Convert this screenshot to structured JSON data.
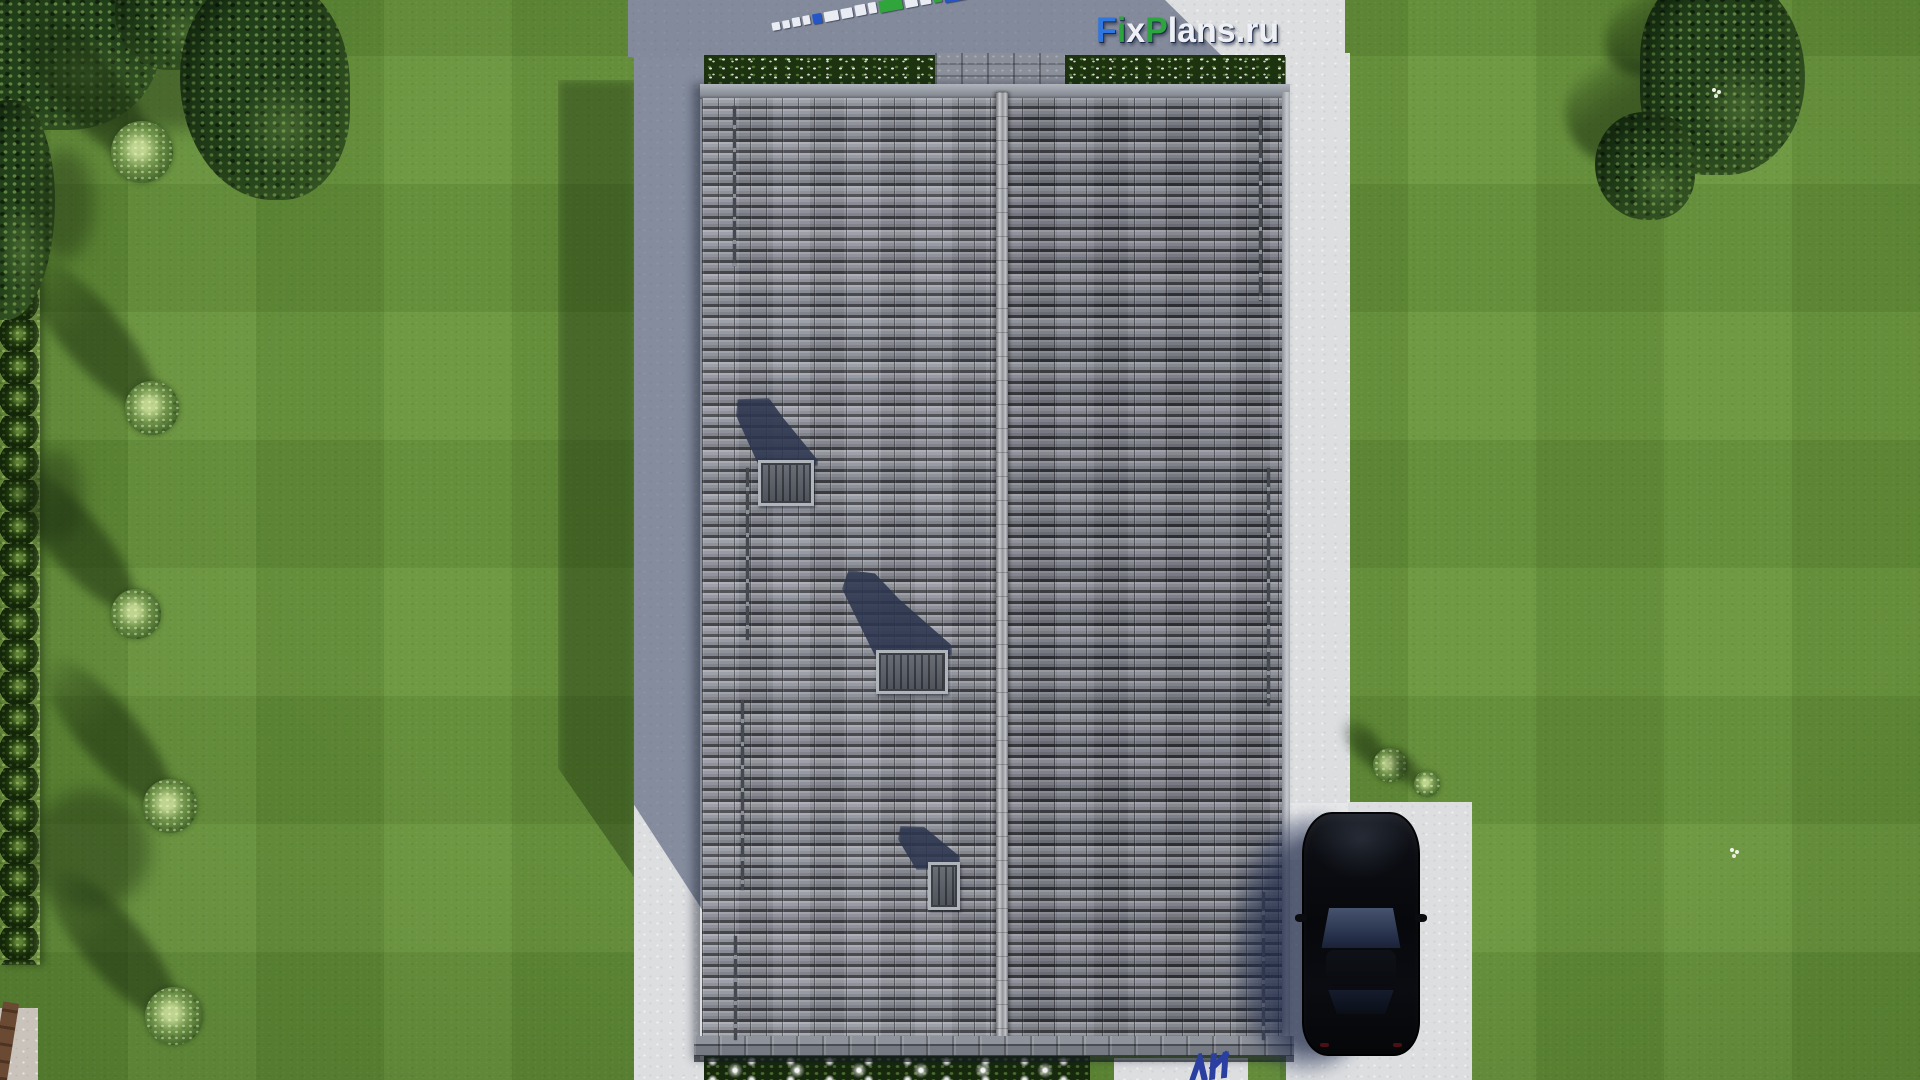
{
  "scene": {
    "title": "Top-down 3D site render: gable-roof house with skylights, lawn, left walkway, right driveway with parked black car",
    "width": 1920,
    "height": 1080,
    "car": {
      "color": "black",
      "state": "parked on driveway, facing up"
    },
    "roof": {
      "slopes": 2,
      "skylights": 3,
      "snow_rails": 7
    }
  },
  "logo": {
    "text": "FixPlans.ru",
    "letters": [
      {
        "ch": "F",
        "color": "#2f76e0"
      },
      {
        "ch": "i",
        "color": "#2da53e"
      },
      {
        "ch": "x",
        "color": "#eef0f5"
      },
      {
        "ch": "P",
        "color": "#2da53e"
      },
      {
        "ch": "l",
        "color": "#eef0f5"
      },
      {
        "ch": "a",
        "color": "#eef0f5"
      },
      {
        "ch": "n",
        "color": "#eef0f5"
      },
      {
        "ch": "s",
        "color": "#eef0f5"
      },
      {
        "ch": ".",
        "color": "#eef0f5"
      },
      {
        "ch": "r",
        "color": "#eef0f5"
      },
      {
        "ch": "u",
        "color": "#eef0f5"
      }
    ],
    "shadow_color": "#1c2a4a"
  },
  "watermark_strip": {
    "description": "perspective 3D watermark lying on terrace pavement",
    "blocks": [
      {
        "w": 9,
        "h": 8,
        "color": "#e9ecf2"
      },
      {
        "w": 8,
        "h": 8,
        "color": "#e9ecf2"
      },
      {
        "w": 9,
        "h": 9,
        "color": "#e9ecf2"
      },
      {
        "w": 8,
        "h": 9,
        "color": "#e9ecf2"
      },
      {
        "w": 10,
        "h": 10,
        "color": "#2456c8"
      },
      {
        "w": 16,
        "h": 10,
        "color": "#e9ecf2"
      },
      {
        "w": 13,
        "h": 10,
        "color": "#e9ecf2"
      },
      {
        "w": 12,
        "h": 11,
        "color": "#e9ecf2"
      },
      {
        "w": 9,
        "h": 11,
        "color": "#e9ecf2"
      },
      {
        "w": 26,
        "h": 12,
        "color": "#2fa53c"
      },
      {
        "w": 14,
        "h": 12,
        "color": "#e9ecf2"
      },
      {
        "w": 12,
        "h": 13,
        "color": "#e9ecf2"
      },
      {
        "w": 9,
        "h": 13,
        "color": "#2fa53c"
      },
      {
        "w": 24,
        "h": 17,
        "color": "#2456c8"
      }
    ]
  },
  "colors": {
    "grass_base": "#65903a",
    "hedge_green": "#24400f",
    "canopy_green": "#22401a",
    "flowerbed_green": "#1d3310",
    "concrete_light": "#dcdee0",
    "terrace_shadow": "#7e8698",
    "roof_tile_mid": "#84878f",
    "ridge": "#b2b5bb",
    "skylight_frame": "#b0b4bb",
    "skylight_glass": "#565a63",
    "car_glass": "#3c4a63",
    "logo_shadow": "#1c2a4a",
    "watermark_blue": "#2456c8",
    "watermark_green": "#2fa53c"
  }
}
